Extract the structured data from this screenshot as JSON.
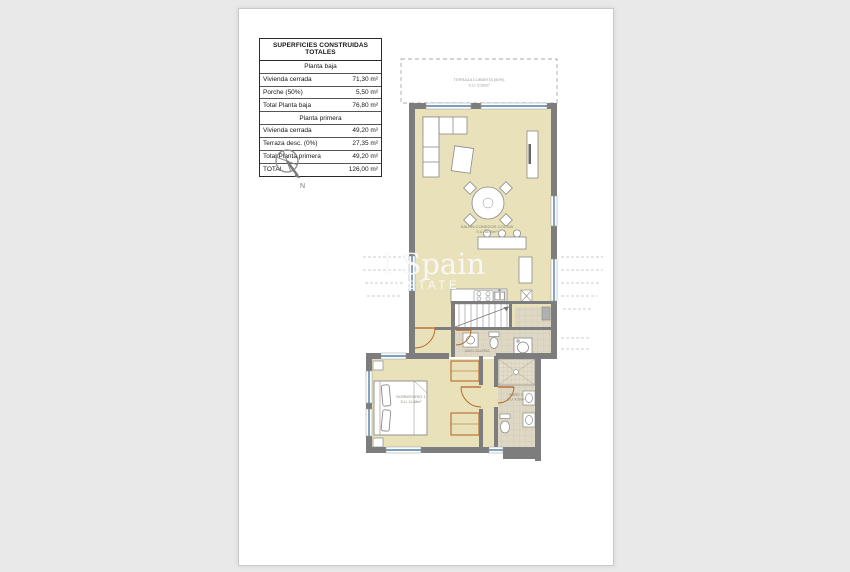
{
  "surface_table": {
    "title": "SUPERFICIES CONSTRUIDAS TOTALES",
    "rows": [
      {
        "type": "section",
        "label": "Planta baja",
        "value": ""
      },
      {
        "type": "data",
        "label": "Vivienda cerrada",
        "value": "71,30 m²"
      },
      {
        "type": "data",
        "label": "Porche (50%)",
        "value": "5,50 m²"
      },
      {
        "type": "total",
        "label": "Total Planta baja",
        "value": "76,80 m²"
      },
      {
        "type": "section",
        "label": "Planta primera",
        "value": ""
      },
      {
        "type": "data",
        "label": "Vivienda cerrada",
        "value": "49,20 m²"
      },
      {
        "type": "data",
        "label": "Terraza desc. (0%)",
        "value": "27,35 m²"
      },
      {
        "type": "total",
        "label": "Total Planta primera",
        "value": "49,20 m²"
      },
      {
        "type": "total",
        "label": "TOTAL",
        "value": "126,00 m²"
      }
    ]
  },
  "compass": {
    "north_label": "N"
  },
  "watermark": {
    "line1": "l Spain",
    "line2": "ESTATE"
  },
  "plan": {
    "labels": {
      "terraza": {
        "line1": "TERRAZA CUBIERTA (50%)",
        "line2": "S.U. 5,50m²"
      },
      "salon": {
        "line1": "SALÓN-COMEDOR-COCINA",
        "line2": "S.U. 36,29m²"
      },
      "dormitorio": {
        "line1": "DORMITORIO 1",
        "line2": "S.U. 11,88m²"
      },
      "bano": {
        "line1": "BAÑO 1",
        "line2": "S.U. 4,50m²"
      },
      "aseo": {
        "line1": "ASEO-GALERÍA"
      }
    },
    "colors": {
      "room_fill": "#e8e1ba",
      "wall": "#7d7d7d",
      "window": "#4d7fa8",
      "door": "#b3611f",
      "tile": "#ded7c3",
      "dashed_outline": "#aaaaaa"
    }
  }
}
